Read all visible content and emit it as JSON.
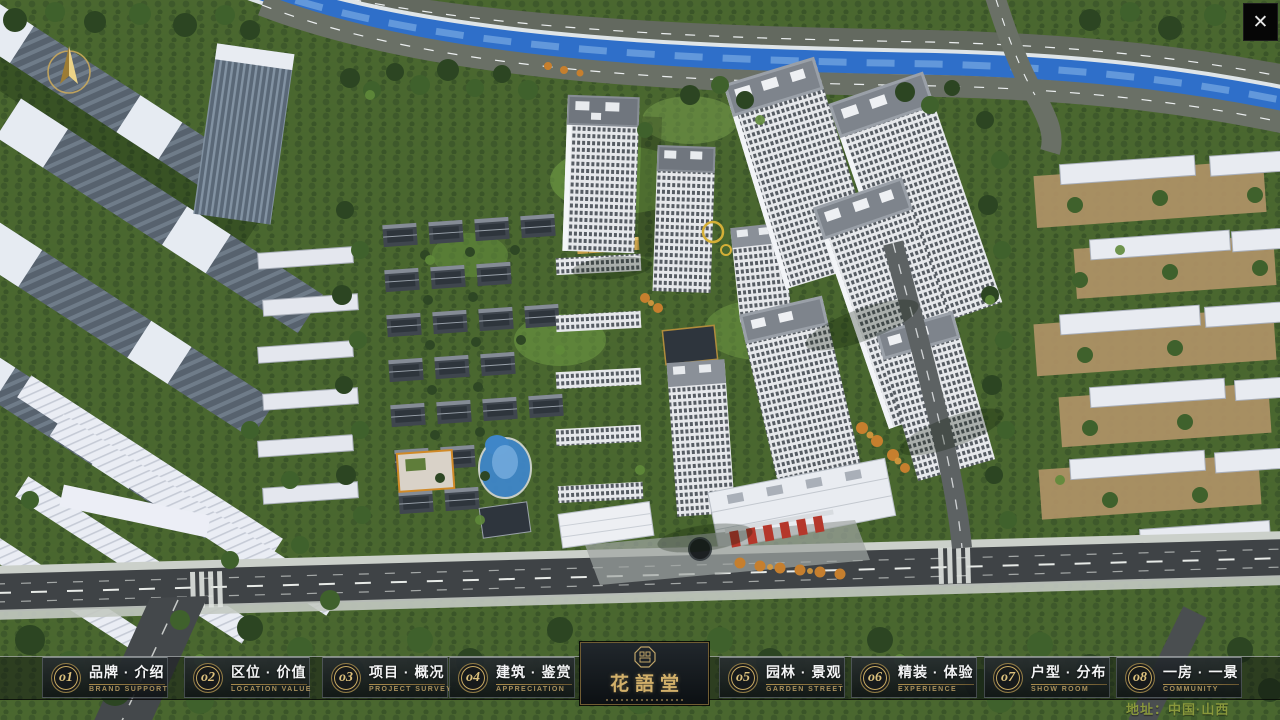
{
  "app": {
    "close_glyph": "✕"
  },
  "nav": {
    "items": [
      {
        "num": "o1",
        "zh": "品牌 · 介绍",
        "en": "BRAND SUPPORT"
      },
      {
        "num": "o2",
        "zh": "区位 · 价值",
        "en": "LOCATION VALUE"
      },
      {
        "num": "o3",
        "zh": "项目 · 概况",
        "en": "PROJECT SURVEY"
      },
      {
        "num": "o4",
        "zh": "建筑 · 鉴赏",
        "en": "APPRECIATION"
      },
      {
        "num": "o5",
        "zh": "园林 · 景观",
        "en": "GARDEN STREET"
      },
      {
        "num": "o6",
        "zh": "精装 · 体验",
        "en": "EXPERIENCE"
      },
      {
        "num": "o7",
        "zh": "户型 · 分布",
        "en": "SHOW ROOM"
      },
      {
        "num": "o8",
        "zh": "一房 · 一景",
        "en": "COMMUNITY"
      }
    ]
  },
  "logo": {
    "title": "花語堂"
  },
  "footer": {
    "address": "地址：中国·山西"
  },
  "colors": {
    "gold": "#c9ab62",
    "nav_bg": "rgba(10,13,15,0.45)",
    "river": "#2f6fc9",
    "en_text": "#a8905c"
  }
}
